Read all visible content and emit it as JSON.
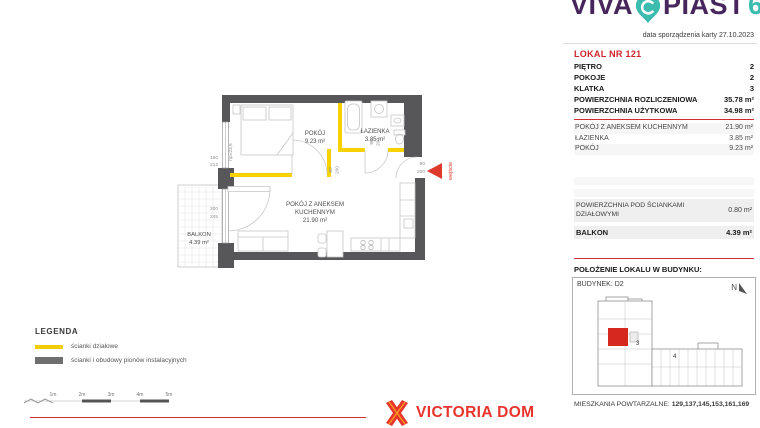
{
  "header": {
    "logo_word1": "VIVA",
    "logo_word2": "PIAST",
    "logo_number": "6",
    "date_note": "data sporządzenia karty 27.10.2023"
  },
  "unit": {
    "title": "LOKAL NR 121",
    "attributes": [
      {
        "label": "PIĘTRO",
        "value": "2"
      },
      {
        "label": "POKOJE",
        "value": "2"
      },
      {
        "label": "KLATKA",
        "value": "3"
      },
      {
        "label": "POWIERZCHNIA ROZLICZENIOWA",
        "value": "35.78 m²"
      },
      {
        "label": "POWIERZCHNIA UŻYTKOWA",
        "value": "34.98 m²"
      }
    ],
    "rooms": [
      {
        "label": "POKÓJ Z ANEKSEM KUCHENNYM",
        "value": "21.90 m²"
      },
      {
        "label": "ŁAZIENKA",
        "value": "3.85 m²"
      },
      {
        "label": "POKÓJ",
        "value": "9.23 m²"
      }
    ],
    "extras": [
      {
        "label": "POWIERZCHNIA POD ŚCIANKAMI DZIAŁOWYMI",
        "value": "0.80 m²"
      },
      {
        "label": "BALKON",
        "value": "4.39 m²"
      }
    ]
  },
  "location": {
    "heading": "POŁOŻENIE LOKALU W BUDYNKU:",
    "building": "BUDYNEK: D2",
    "north": "N",
    "stairwell_3": "3",
    "stairwell_4": "4",
    "repeat_label": "MIESZKANIA POWTARZALNE:",
    "repeat_units": "129,137,145,153,161,169"
  },
  "plan": {
    "bedroom_name": "POKÓJ",
    "bedroom_area": "9.23 m²",
    "bathroom_name": "ŁAZIENKA",
    "bathroom_area": "3.85 m²",
    "living_name_line1": "POKÓJ Z ANEKSEM",
    "living_name_line2": "KUCHENNYM",
    "living_area": "21.90 m²",
    "balcony_name": "BALKON",
    "balcony_area": "4.39 m²",
    "dim_window_w": "160",
    "dim_window_h": "212",
    "dim_window_hp": "hp=23,5",
    "dim_balcony_w": "200",
    "dim_balcony_h": "245",
    "dim_bedroom_door_w": "80",
    "dim_bedroom_door_h": "200",
    "dim_bathroom_door_w": "80",
    "dim_bathroom_door_h": "200",
    "dim_entry_w": "90",
    "dim_entry_h": "200",
    "entry_label": "wejście"
  },
  "legend": {
    "title": "LEGENDA",
    "items": [
      {
        "label": "ścianki działowe"
      },
      {
        "label": "ścianki i obudowy pionów instalacyjnych"
      }
    ]
  },
  "scalebar": {
    "labels": [
      "1m",
      "2m",
      "3m",
      "4m",
      "5m"
    ]
  },
  "brand": {
    "name": "VICTORIA DOM"
  },
  "colors": {
    "accent_red": "#d2232a",
    "wall_gray": "#57575a",
    "partition_yellow": "#f8d200",
    "brand_purple": "#46265c",
    "brand_teal": "#3cbcae",
    "victoria_red": "#e8342c"
  }
}
